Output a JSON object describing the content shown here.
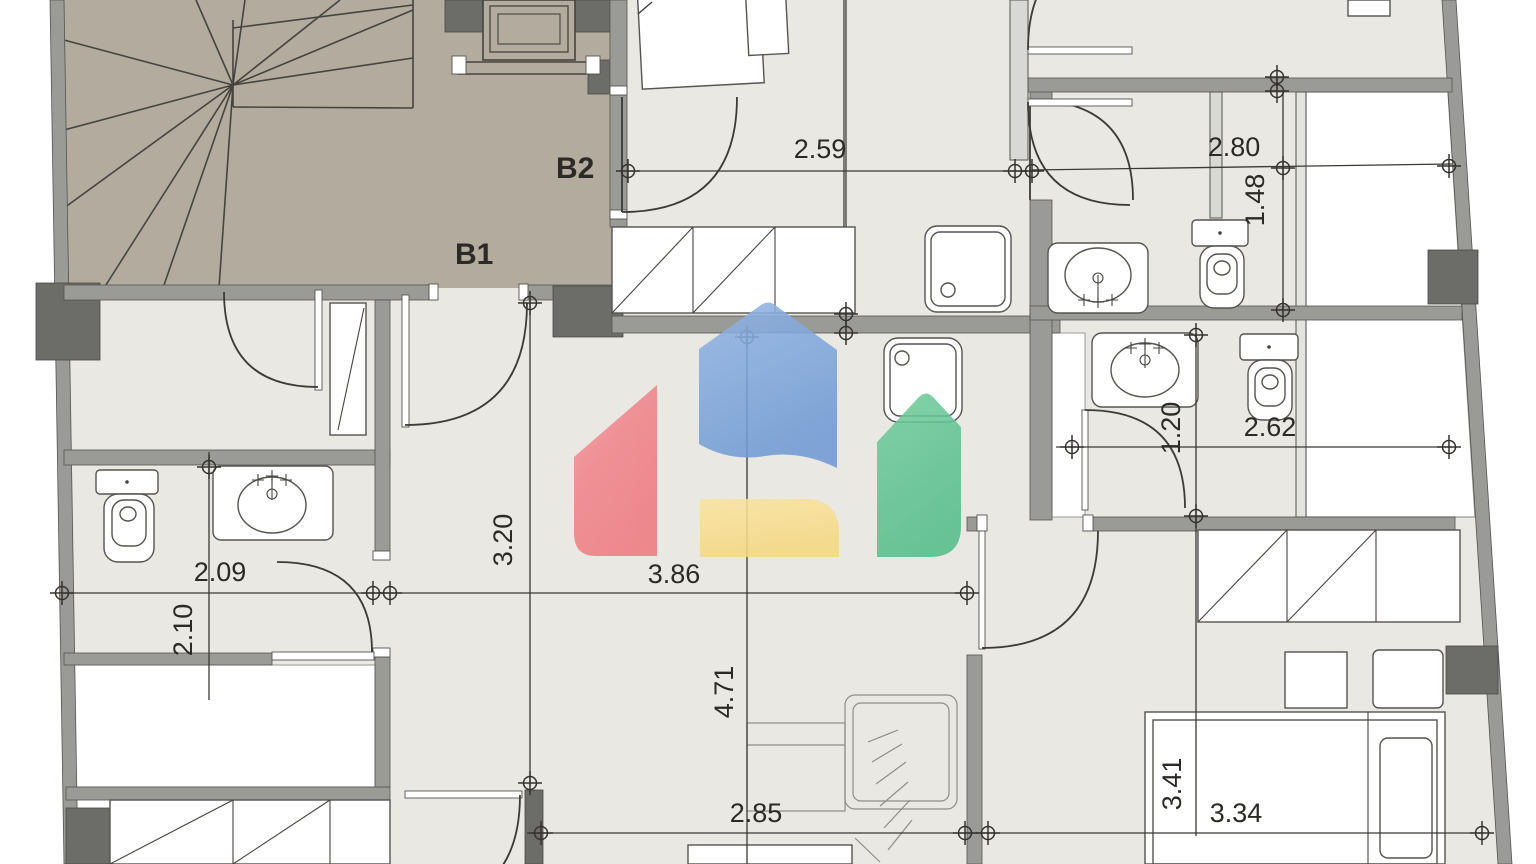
{
  "plan": {
    "type": "architectural floor plan",
    "unit_labels": {
      "b1": "B1",
      "b2": "B2"
    },
    "dimensions": {
      "top_center_room_width": "2.59",
      "top_right_room_width": "2.80",
      "top_right_room_depth": "1.48",
      "hallway_depth": "3.20",
      "living_room_width": "3.86",
      "left_bathroom_width": "2.09",
      "left_bathroom_depth": "2.10",
      "living_room_depth": "4.71",
      "center_bedroom_width": "2.85",
      "right_bathroom_depth": "1.20",
      "right_bathroom_width": "2.62",
      "right_bedroom_depth": "3.41",
      "right_bedroom_width": "3.34"
    },
    "colors": {
      "floor": "#e9e8e3",
      "stairwell": "#b3ab9e",
      "walls": "#9a9a96",
      "walls_dark": "#6c6c68"
    },
    "watermark": {
      "icon": "house-logo",
      "red": "#f0838a",
      "blue": "#7fa7dc",
      "yellow": "#f7dc8d",
      "green": "#5ec391"
    }
  }
}
